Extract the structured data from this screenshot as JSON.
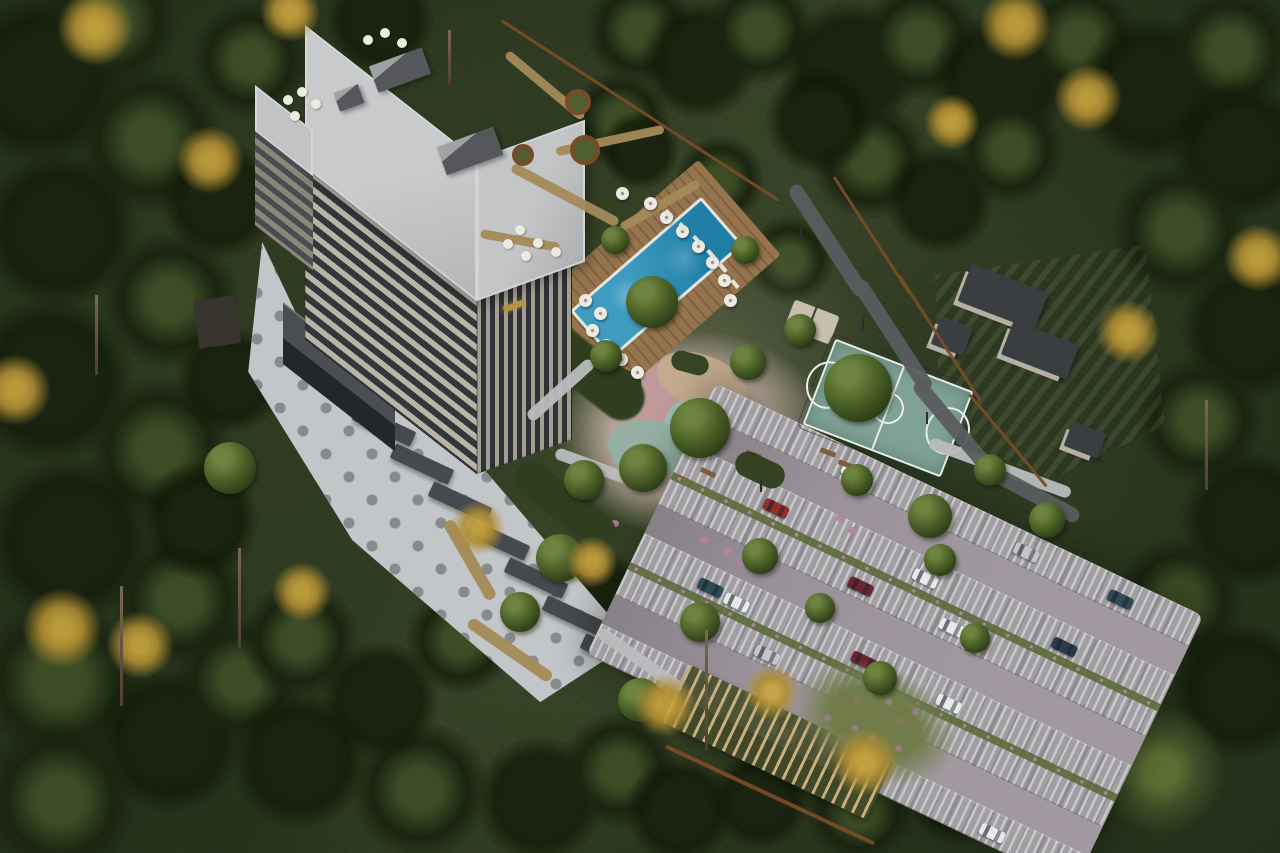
{
  "scene": {
    "title": "Aerial rendering of a residential tower complex with pool, playground, sports court and parking in a pine forest",
    "setting": "bird's-eye architectural visualization, autumn-tinged evergreen forest",
    "building": {
      "name": "residential tower",
      "floors_visible": 10,
      "sign": "small gold logo on upper facade (illegible)"
    },
    "amenities": [
      "outdoor swimming pool with wood deck and white umbrellas",
      "pool house",
      "children's playground with pastel rubber surfacing",
      "basketball court",
      "lawn with concrete pavilions",
      "surface parking with grass pavers",
      "wood pergola",
      "winding forest paths",
      "round corten planters"
    ],
    "colors": {
      "forest_base": "#26331c",
      "forest_dark": "#1a2410",
      "forest_mid": "#3c4d26",
      "forest_light": "#5d7034",
      "autumn_gold": "#b08d33",
      "autumn_bright": "#c9a63f",
      "trunk": "#7a6852",
      "roof_light": "#c9cacc",
      "roof_dark": "#55575a",
      "facade_light": "#b9b3a8",
      "facade_dark": "#a49d91",
      "window_dark": "#33363a",
      "glass_dark": "#2e3135",
      "plaza": "#c3c6c9",
      "plaza_dot": "#878b8e",
      "slab_dark": "#46494d",
      "pool_water": "#3e9cc0",
      "pool_water_deep": "#1f7fa6",
      "pool_coping": "#e3e5e2",
      "deck_wood": "#96754e",
      "poolhouse_roof": "#34383b",
      "umbrella_white": "#eceae2",
      "court_surface": "#7fa295",
      "court_line": "#e8ece9",
      "lawn_green": "#66793e",
      "pavilion_roof": "#3b3e41",
      "pavilion_wall": "#b6b0a4",
      "parking_base": "#8f8a8f",
      "parking_stripe": "#c6c9cb",
      "parking_aisle": "#9b929a",
      "path_tan": "#a38a58",
      "path_gray": "#b9bcbe",
      "road_dark": "#5a5c5e",
      "fence_corten": "#7a4a28",
      "pergola_wood": "#c9ae7e",
      "garden_olive": "#5c6b3a",
      "flower_pink": "#b77fa3",
      "sand": "#d9cda9",
      "rubber_pink": "#c2989b",
      "rubber_teal": "#9dbfb2",
      "logo_gold": "#b59344",
      "car_white": "#e8e9ea",
      "car_silver": "#c3c6c8",
      "car_red": "#8e2f2c",
      "car_maroon": "#6b2430",
      "car_teal": "#2e4a52",
      "car_navy": "#2a3a4e",
      "shrub_dark": "#2f3e1e"
    },
    "forest_blobs": [
      [
        40,
        80,
        85,
        "dark"
      ],
      [
        150,
        140,
        75,
        "mid"
      ],
      [
        60,
        230,
        80,
        "dark"
      ],
      [
        170,
        300,
        70,
        "mid"
      ],
      [
        50,
        380,
        85,
        "dark"
      ],
      [
        160,
        450,
        75,
        "mid"
      ],
      [
        70,
        540,
        85,
        "dark"
      ],
      [
        180,
        600,
        70,
        "mid"
      ],
      [
        60,
        680,
        85,
        "mid"
      ],
      [
        170,
        740,
        75,
        "dark"
      ],
      [
        60,
        800,
        80,
        "mid"
      ],
      [
        200,
        520,
        60,
        "dark"
      ],
      [
        230,
        380,
        55,
        "dark"
      ],
      [
        220,
        200,
        60,
        "dark"
      ],
      [
        240,
        680,
        65,
        "mid"
      ],
      [
        300,
        760,
        70,
        "dark"
      ],
      [
        420,
        790,
        70,
        "mid"
      ],
      [
        540,
        800,
        65,
        "dark"
      ],
      [
        300,
        640,
        60,
        "mid"
      ],
      [
        380,
        700,
        60,
        "dark"
      ],
      [
        460,
        640,
        55,
        "mid"
      ],
      [
        250,
        60,
        60,
        "mid"
      ],
      [
        620,
        770,
        60,
        "mid"
      ],
      [
        680,
        810,
        55,
        "dark"
      ],
      [
        640,
        30,
        55,
        "mid"
      ],
      [
        700,
        60,
        60,
        "dark"
      ],
      [
        760,
        30,
        55,
        "mid"
      ],
      [
        850,
        70,
        70,
        "dark"
      ],
      [
        920,
        40,
        60,
        "mid"
      ],
      [
        1000,
        80,
        70,
        "dark"
      ],
      [
        1080,
        40,
        60,
        "mid"
      ],
      [
        1150,
        90,
        75,
        "dark"
      ],
      [
        1230,
        50,
        65,
        "mid"
      ],
      [
        1240,
        150,
        70,
        "dark"
      ],
      [
        870,
        160,
        60,
        "mid"
      ],
      [
        940,
        200,
        55,
        "dark"
      ],
      [
        1010,
        150,
        55,
        "mid"
      ],
      [
        1180,
        230,
        70,
        "mid"
      ],
      [
        1250,
        330,
        70,
        "dark"
      ],
      [
        1200,
        420,
        65,
        "mid"
      ],
      [
        1250,
        520,
        70,
        "dark"
      ],
      [
        1180,
        600,
        65,
        "mid"
      ],
      [
        1240,
        690,
        70,
        "dark"
      ],
      [
        1160,
        770,
        65,
        "light"
      ],
      [
        1060,
        800,
        60,
        "mid"
      ],
      [
        960,
        790,
        55,
        "dark"
      ],
      [
        860,
        810,
        55,
        "mid"
      ],
      [
        760,
        800,
        50,
        "dark"
      ],
      [
        1100,
        680,
        55,
        "light"
      ],
      [
        820,
        120,
        55,
        "dark"
      ],
      [
        620,
        120,
        50,
        "mid"
      ],
      [
        640,
        150,
        40,
        "dark"
      ],
      [
        720,
        180,
        45,
        "mid"
      ],
      [
        600,
        600,
        50,
        "dark"
      ],
      [
        660,
        650,
        45,
        "mid"
      ],
      [
        790,
        260,
        45,
        "mid"
      ],
      [
        110,
        20,
        70,
        "mid"
      ],
      [
        380,
        20,
        55,
        "dark"
      ]
    ],
    "trees": [
      [
        652,
        302,
        26
      ],
      [
        700,
        428,
        30
      ],
      [
        643,
        468,
        24
      ],
      [
        748,
        362,
        18
      ],
      [
        858,
        388,
        34
      ],
      [
        800,
        330,
        16
      ],
      [
        930,
        516,
        22
      ],
      [
        857,
        480,
        16
      ],
      [
        940,
        560,
        16
      ],
      [
        760,
        556,
        18
      ],
      [
        820,
        608,
        15
      ],
      [
        700,
        622,
        20
      ],
      [
        880,
        678,
        17
      ],
      [
        975,
        638,
        15
      ],
      [
        640,
        700,
        22
      ],
      [
        560,
        558,
        24
      ],
      [
        520,
        612,
        20
      ],
      [
        584,
        480,
        20
      ],
      [
        230,
        468,
        26
      ],
      [
        606,
        356,
        16
      ],
      [
        1047,
        520,
        18
      ],
      [
        745,
        250,
        14
      ],
      [
        990,
        470,
        16
      ],
      [
        615,
        240,
        14
      ]
    ],
    "autumn": [
      [
        95,
        28,
        38
      ],
      [
        210,
        160,
        34
      ],
      [
        15,
        390,
        36
      ],
      [
        62,
        628,
        40
      ],
      [
        140,
        645,
        34
      ],
      [
        302,
        592,
        30
      ],
      [
        478,
        528,
        28
      ],
      [
        592,
        562,
        26
      ],
      [
        665,
        705,
        32
      ],
      [
        772,
        692,
        28
      ],
      [
        865,
        762,
        34
      ],
      [
        1015,
        25,
        36
      ],
      [
        1088,
        98,
        34
      ],
      [
        1128,
        332,
        32
      ],
      [
        1258,
        258,
        34
      ],
      [
        952,
        122,
        28
      ],
      [
        290,
        12,
        30
      ]
    ],
    "trunks": [
      [
        238,
        548,
        100
      ],
      [
        120,
        586,
        120
      ],
      [
        95,
        295,
        80
      ],
      [
        705,
        630,
        120
      ],
      [
        1205,
        400,
        90
      ],
      [
        448,
        30,
        55
      ]
    ],
    "umbrellas": {
      "deck": [
        [
          650,
          203
        ],
        [
          666,
          217
        ],
        [
          682,
          231
        ],
        [
          698,
          246
        ],
        [
          712,
          262
        ],
        [
          724,
          280
        ],
        [
          730,
          300
        ],
        [
          592,
          330
        ],
        [
          606,
          345
        ],
        [
          621,
          359
        ],
        [
          637,
          372
        ],
        [
          600,
          313
        ],
        [
          585,
          300
        ],
        [
          622,
          193
        ]
      ],
      "roof": [
        [
          368,
          40
        ],
        [
          385,
          33
        ],
        [
          402,
          43
        ],
        [
          288,
          100
        ],
        [
          302,
          92
        ],
        [
          316,
          104
        ],
        [
          295,
          116
        ],
        [
          520,
          230
        ],
        [
          538,
          243
        ],
        [
          526,
          256
        ],
        [
          508,
          244
        ],
        [
          556,
          252
        ]
      ]
    },
    "loungers": [
      [
        664,
        212
      ],
      [
        678,
        225
      ],
      [
        692,
        238
      ],
      [
        706,
        252
      ],
      [
        718,
        266
      ],
      [
        730,
        282
      ]
    ],
    "paths": [
      [
        545,
        85,
        100,
        9,
        40,
        "path_tan"
      ],
      [
        610,
        140,
        110,
        9,
        -12,
        "path_tan"
      ],
      [
        565,
        195,
        120,
        10,
        28,
        "path_tan"
      ],
      [
        660,
        205,
        90,
        9,
        -30,
        "path_tan"
      ],
      [
        520,
        240,
        80,
        9,
        10,
        "path_tan"
      ],
      [
        470,
        560,
        90,
        12,
        60,
        "path_tan"
      ],
      [
        510,
        650,
        100,
        12,
        35,
        "path_tan"
      ],
      [
        560,
        390,
        85,
        12,
        -42,
        "path_gray"
      ],
      [
        598,
        468,
        90,
        12,
        20,
        "path_gray"
      ],
      [
        640,
        660,
        100,
        12,
        35,
        "path_gray"
      ],
      [
        1000,
        468,
        150,
        12,
        20,
        "path_gray"
      ],
      [
        828,
        240,
        130,
        15,
        57,
        "road_dark"
      ],
      [
        893,
        335,
        130,
        15,
        57,
        "road_dark"
      ],
      [
        955,
        428,
        120,
        15,
        50,
        "road_dark"
      ],
      [
        1030,
        492,
        110,
        15,
        28,
        "road_dark"
      ],
      [
        640,
        110,
        330,
        3,
        33,
        "fence_corten"
      ],
      [
        872,
        235,
        140,
        3,
        57,
        "fence_corten"
      ],
      [
        940,
        338,
        150,
        3,
        57,
        "fence_corten"
      ],
      [
        1008,
        440,
        120,
        3,
        50,
        "fence_corten"
      ],
      [
        770,
        795,
        230,
        4,
        25,
        "fence_corten"
      ]
    ],
    "planters": [
      [
        578,
        102,
        13
      ],
      [
        585,
        150,
        15
      ],
      [
        523,
        155,
        11
      ]
    ],
    "pavilions": [
      [
        1003,
        297,
        82,
        40
      ],
      [
        1040,
        350,
        70,
        36
      ],
      [
        952,
        336,
        34,
        30
      ],
      [
        1085,
        440,
        36,
        26
      ]
    ],
    "slabs": {
      "x": 352,
      "y": 418,
      "dx": 38,
      "dy": 38,
      "count": 7,
      "w": 64,
      "h": 16,
      "angle": 25
    },
    "benches": [
      [
        745,
        452,
        20
      ],
      [
        700,
        470,
        25
      ],
      [
        820,
        450,
        21
      ],
      [
        838,
        462,
        21
      ]
    ],
    "flowers": [
      [
        723,
        548
      ],
      [
        737,
        559
      ],
      [
        700,
        536
      ],
      [
        836,
        515
      ],
      [
        848,
        527
      ],
      [
        645,
        452
      ],
      [
        610,
        520
      ]
    ],
    "shrubs": [
      [
        620,
        380,
        44,
        24,
        20
      ],
      [
        760,
        470,
        52,
        26,
        25
      ],
      [
        690,
        363,
        38,
        20,
        15
      ],
      [
        565,
        505,
        120,
        34,
        38
      ]
    ],
    "lamps": [
      [
        800,
        228
      ],
      [
        862,
        318
      ],
      [
        926,
        412
      ],
      [
        760,
        480
      ]
    ],
    "parking": {
      "angle": 25.5,
      "cx": 895,
      "cy": 635,
      "w": 540,
      "h": 300,
      "bands": [
        [
          "s",
          0
        ],
        [
          "a",
          34
        ],
        [
          "s",
          66
        ],
        [
          "s",
          100
        ],
        [
          "a",
          134
        ],
        [
          "s",
          166
        ],
        [
          "s",
          200
        ],
        [
          "a",
          234
        ],
        [
          "s",
          266
        ]
      ],
      "green_strips": [
        98,
        198
      ],
      "cars": [
        [
          150,
          15,
          "car_white"
        ],
        [
          340,
          13,
          "car_silver"
        ],
        [
          445,
          15,
          "car_teal"
        ],
        [
          95,
          81,
          "car_red"
        ],
        [
          260,
          80,
          "car_white"
        ],
        [
          415,
          82,
          "car_navy"
        ],
        [
          205,
          115,
          "car_maroon"
        ],
        [
          305,
          113,
          "car_white"
        ],
        [
          70,
          181,
          "car_teal"
        ],
        [
          100,
          183,
          "car_white"
        ],
        [
          240,
          181,
          "car_maroon"
        ],
        [
          335,
          183,
          "car_white"
        ],
        [
          150,
          217,
          "car_silver"
        ],
        [
          260,
          215,
          "car_white"
        ],
        [
          200,
          281,
          "car_white"
        ],
        [
          270,
          283,
          "car_red"
        ],
        [
          430,
          281,
          "car_white"
        ]
      ]
    }
  }
}
